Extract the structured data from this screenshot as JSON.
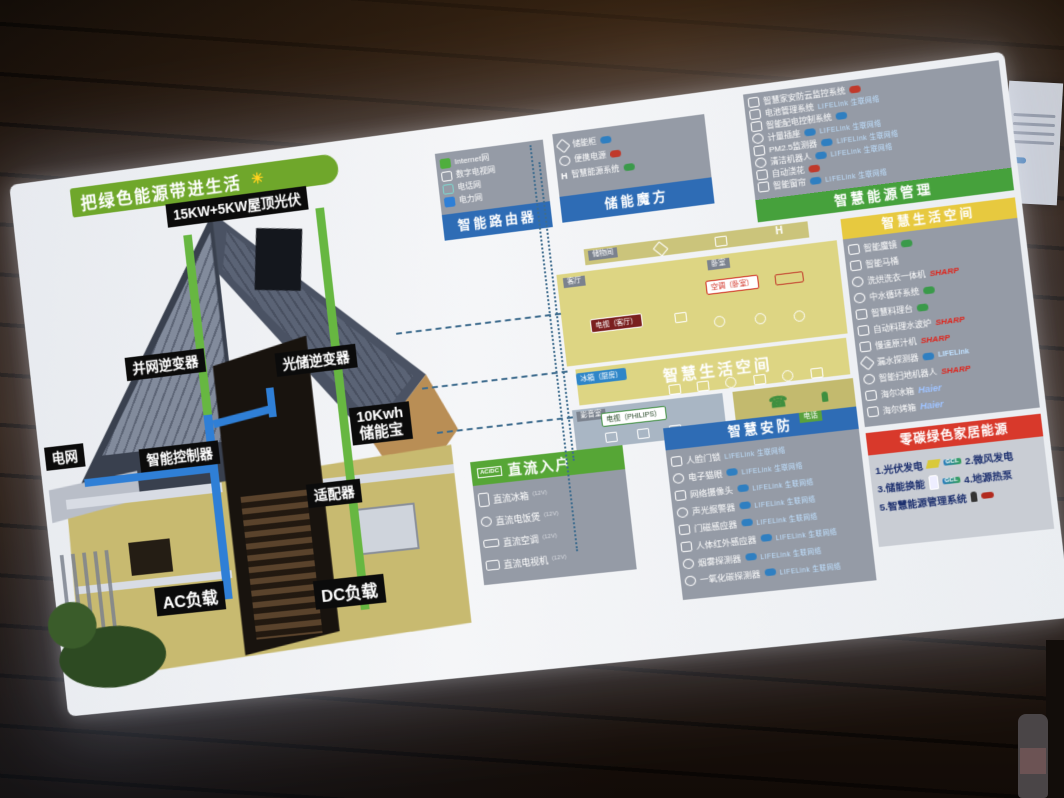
{
  "banner": {
    "text": "把绿色能源带进生活",
    "sun": "☀"
  },
  "house": {
    "labels": {
      "rooftop_pv": "15KW+5KW屋顶光伏",
      "grid_inverter": "并网逆变器",
      "solar_storage_inverter": "光储逆变器",
      "grid": "电网",
      "smart_controller": "智能控制器",
      "storage_line1": "10Kwh",
      "storage_line2": "储能宝",
      "adapter": "适配器",
      "ac_load": "AC负载",
      "dc_load": "DC负载"
    }
  },
  "router": {
    "title": "智能路由器",
    "items": [
      {
        "label": "Internet网"
      },
      {
        "label": "数字电视网"
      },
      {
        "label": "电话网"
      },
      {
        "label": "电力网"
      }
    ]
  },
  "cube": {
    "title": "储能魔方",
    "items": [
      {
        "label": "储能柜"
      },
      {
        "label": "便携电源"
      },
      {
        "label": "智慧能源系统"
      }
    ]
  },
  "energy_mgmt": {
    "title": "智慧能源管理",
    "brand_lifelink": "LIFELink 生联网络",
    "items": [
      {
        "label": "智慧家安防云监控系统"
      },
      {
        "label": "电池管理系统"
      },
      {
        "label": "智能配电控制系统"
      },
      {
        "label": "计量插座"
      },
      {
        "label": "PM2.5监测器"
      },
      {
        "label": "清洁机器人"
      },
      {
        "label": "自动浇花"
      },
      {
        "label": "智能窗帘"
      }
    ]
  },
  "life_space": {
    "title": "智慧生活空间",
    "items": [
      {
        "label": "智能魔镜",
        "brand": ""
      },
      {
        "label": "智能马桶",
        "brand": ""
      },
      {
        "label": "洗烘洗衣一体机",
        "brand": "SHARP"
      },
      {
        "label": "中水循环系统",
        "brand": ""
      },
      {
        "label": "智慧料理台",
        "brand": ""
      },
      {
        "label": "自动料理水波炉",
        "brand": "SHARP"
      },
      {
        "label": "慢速原汁机",
        "brand": "SHARP"
      },
      {
        "label": "漏水探测器",
        "brand": "LIFELink"
      },
      {
        "label": "智能扫地机器人",
        "brand": "SHARP"
      },
      {
        "label": "海尔冰箱",
        "brand": "Haier"
      },
      {
        "label": "海尔烤箱",
        "brand": "Haier"
      }
    ]
  },
  "floorplan": {
    "big_title": "智慧生活空间",
    "tags": {
      "storage": "储物间",
      "living": "客厅",
      "bedroom": "卧室",
      "kitchen": "厨房",
      "av_room": "影音室",
      "phone": "电话"
    },
    "badges": {
      "tv_living": "电视（客厅）",
      "ac_bedroom": "空调（卧室）",
      "fridge": "冰箱（厨房）",
      "tv_philips": "电视（PHILIPS）"
    },
    "phone_glyph": "☎"
  },
  "dc_home": {
    "title": "直流入户",
    "badge": "AC/DC",
    "items": [
      {
        "label": "直流冰箱",
        "spec": "(12V)"
      },
      {
        "label": "直流电饭煲",
        "spec": "(12V)"
      },
      {
        "label": "直流空调",
        "spec": "(12V)"
      },
      {
        "label": "直流电视机",
        "spec": "(12V)"
      }
    ]
  },
  "security": {
    "title": "智慧安防",
    "brand_lifelink": "LIFELink 生联网络",
    "items": [
      {
        "label": "人脸门锁"
      },
      {
        "label": "电子猫眼"
      },
      {
        "label": "网络摄像头"
      },
      {
        "label": "声光报警器"
      },
      {
        "label": "门磁感应器"
      },
      {
        "label": "人体红外感应器"
      },
      {
        "label": "烟雾探测器"
      },
      {
        "label": "一氧化碳探测器"
      }
    ]
  },
  "zero_carbon": {
    "title": "零碳绿色家居能源",
    "brand_gcl": "GCL",
    "items": [
      {
        "label": "1.光伏发电"
      },
      {
        "label": "2.微风发电"
      },
      {
        "label": "3.储能换能"
      },
      {
        "label": "4.地源热泵"
      },
      {
        "label": "5.智慧能源管理系统"
      }
    ]
  },
  "colors": {
    "banner_green": "#6fa72b",
    "panel_blue": "#2e6cb5",
    "panel_green": "#46a13c",
    "panel_yellow": "#e7c93f",
    "panel_red": "#d8392b",
    "sharp_red": "#e0231a",
    "haier_blue": "#1a5bb5",
    "lifelink_blue": "#2f7fc1",
    "ac_line_blue": "#2f7fd6",
    "dc_line_green": "#67b741"
  }
}
